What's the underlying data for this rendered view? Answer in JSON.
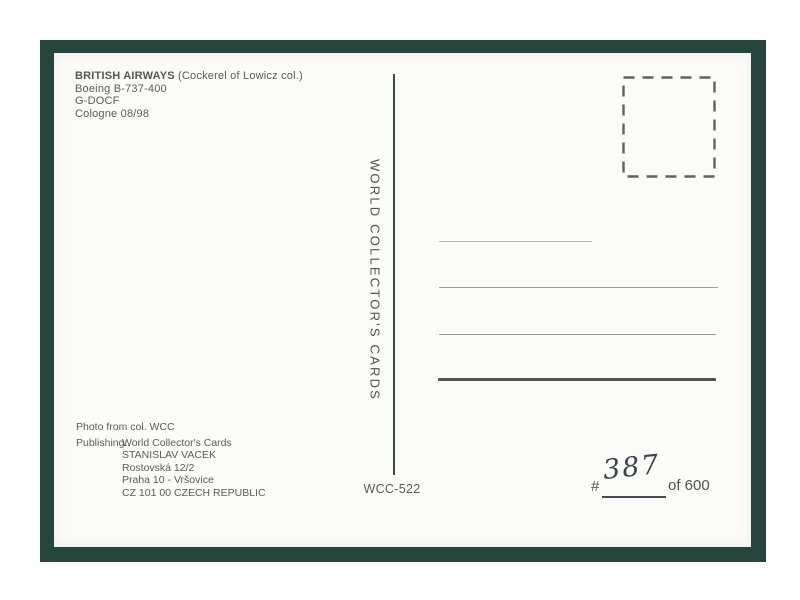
{
  "postcard": {
    "caption": {
      "airline": "BRITISH AIRWAYS",
      "note": "(Cockerel of Lowicz col.)",
      "aircraft": "Boeing B-737-400",
      "registration": "G-DOCF",
      "place_date": "Cologne 08/98"
    },
    "spine_text": "WORLD COLLECTOR'S CARDS",
    "card_ref": "WCC-522",
    "credits": {
      "photo": "Photo from col. WCC",
      "publishing_label": "Publishing:",
      "publisher": [
        "World Collector's Cards",
        "STANISLAV VACEK",
        "Rostovská 12/2",
        "Praha 10 - Vršovice",
        "CZ 101 00 CZECH REPUBLIC"
      ]
    },
    "edition": {
      "hash": "#",
      "number": "387",
      "of": "of 600"
    },
    "colors": {
      "frame": "#24443c",
      "card": "#fbfbf8",
      "print_text": "#575d5a",
      "ink": "#39434e"
    }
  }
}
